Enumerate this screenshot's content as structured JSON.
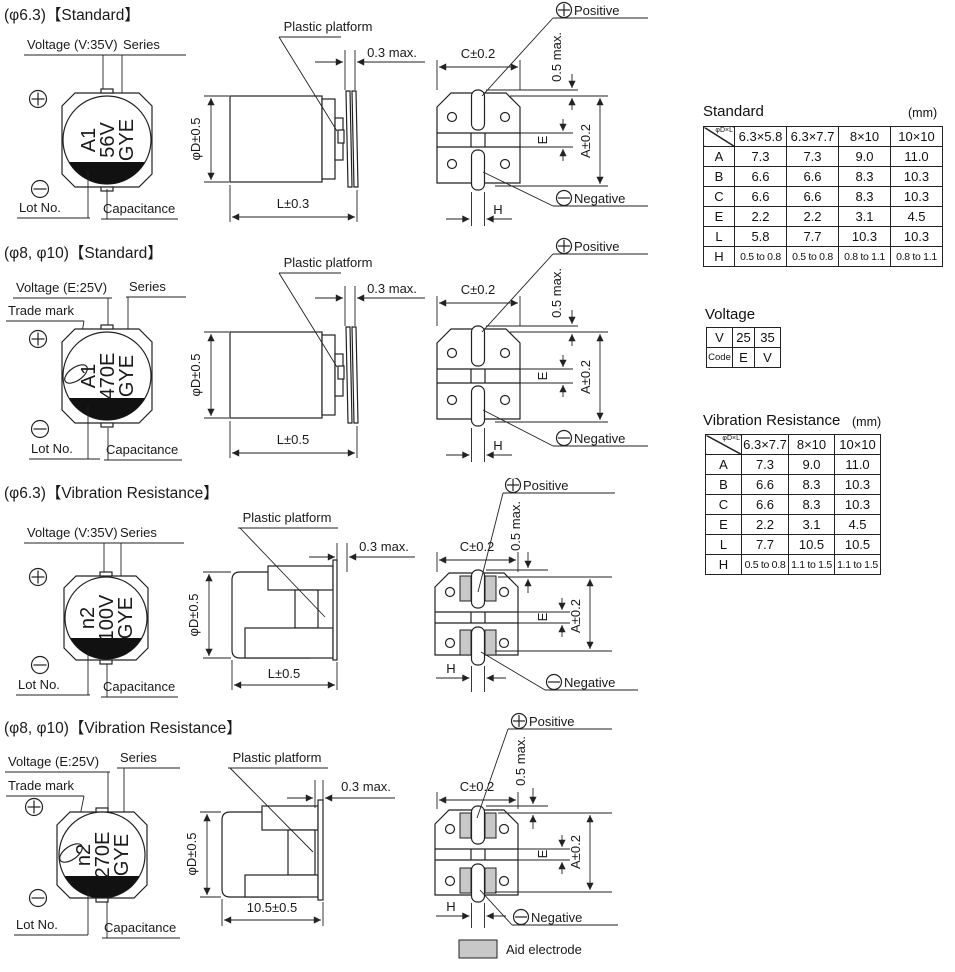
{
  "s1": {
    "title": "(φ6.3)【Standard】",
    "voltage": "Voltage (V:35V)",
    "series": "Series",
    "lot": "Lot No.",
    "cap": "Capacitance",
    "platform": "Plastic platform",
    "gap": "0.3 max.",
    "dia": "φD±0.5",
    "len": "L±0.3",
    "c": "C±0.2",
    "overhang": "0.5 max.",
    "a": "A±0.2",
    "e": "E",
    "h": "H",
    "positive": "Positive",
    "negative": "Negative",
    "m1": "A1",
    "m2": "56V",
    "m3": "GYE"
  },
  "s2": {
    "title": "(φ8, φ10)【Standard】",
    "voltage": "Voltage (E:25V)",
    "series": "Series",
    "trademark": "Trade mark",
    "lot": "Lot No.",
    "cap": "Capacitance",
    "platform": "Plastic platform",
    "gap": "0.3 max.",
    "dia": "φD±0.5",
    "len": "L±0.5",
    "c": "C±0.2",
    "overhang": "0.5 max.",
    "a": "A±0.2",
    "e": "E",
    "h": "H",
    "positive": "Positive",
    "negative": "Negative",
    "m1": "A1",
    "m2": "470E",
    "m3": "GYE"
  },
  "s3": {
    "title": "(φ6.3)【Vibration Resistance】",
    "voltage": "Voltage (V:35V)",
    "series": "Series",
    "lot": "Lot No.",
    "cap": "Capacitance",
    "platform": "Plastic platform",
    "gap": "0.3 max.",
    "dia": "φD±0.5",
    "len": "L±0.5",
    "c": "C±0.2",
    "overhang": "0.5 max.",
    "a": "A±0.2",
    "e": "E",
    "h": "H",
    "positive": "Positive",
    "negative": "Negative",
    "m1": "n2",
    "m2": "100V",
    "m3": "GYE"
  },
  "s4": {
    "title": "(φ8, φ10)【Vibration Resistance】",
    "voltage": "Voltage (E:25V)",
    "series": "Series",
    "trademark": "Trade mark",
    "lot": "Lot No.",
    "cap": "Capacitance",
    "platform": "Plastic platform",
    "gap": "0.3 max.",
    "dia": "φD±0.5",
    "len": "10.5±0.5",
    "c": "C±0.2",
    "overhang": "0.5 max.",
    "a": "A±0.2",
    "e": "E",
    "h": "H",
    "positive": "Positive",
    "negative": "Negative",
    "m1": "n2",
    "m2": "270E",
    "m3": "GYE"
  },
  "legend": {
    "label": "Aid electrode"
  },
  "tables": {
    "standard": {
      "title": "Standard",
      "unit": "(mm)",
      "corner": "φD×L",
      "columns": [
        "6.3×5.8",
        "6.3×7.7",
        "8×10",
        "10×10"
      ],
      "rows": [
        {
          "label": "A",
          "values": [
            "7.3",
            "7.3",
            "9.0",
            "11.0"
          ]
        },
        {
          "label": "B",
          "values": [
            "6.6",
            "6.6",
            "8.3",
            "10.3"
          ]
        },
        {
          "label": "C",
          "values": [
            "6.6",
            "6.6",
            "8.3",
            "10.3"
          ]
        },
        {
          "label": "E",
          "values": [
            "2.2",
            "2.2",
            "3.1",
            "4.5"
          ]
        },
        {
          "label": "L",
          "values": [
            "5.8",
            "7.7",
            "10.3",
            "10.3"
          ]
        },
        {
          "label": "H",
          "values": [
            "0.5 to 0.8",
            "0.5 to 0.8",
            "0.8 to 1.1",
            "0.8 to 1.1"
          ]
        }
      ]
    },
    "voltage": {
      "title": "Voltage",
      "rows": [
        [
          "V",
          "25",
          "35"
        ],
        [
          "Code",
          "E",
          "V"
        ]
      ]
    },
    "vibration": {
      "title": "Vibration Resistance",
      "unit": "(mm)",
      "corner": "φD×L",
      "columns": [
        "6.3×7.7",
        "8×10",
        "10×10"
      ],
      "rows": [
        {
          "label": "A",
          "values": [
            "7.3",
            "9.0",
            "11.0"
          ]
        },
        {
          "label": "B",
          "values": [
            "6.6",
            "8.3",
            "10.3"
          ]
        },
        {
          "label": "C",
          "values": [
            "6.6",
            "8.3",
            "10.3"
          ]
        },
        {
          "label": "E",
          "values": [
            "2.2",
            "3.1",
            "4.5"
          ]
        },
        {
          "label": "L",
          "values": [
            "7.7",
            "10.5",
            "10.5"
          ]
        },
        {
          "label": "H",
          "values": [
            "0.5 to 0.8",
            "1.1 to 1.5",
            "1.1 to 1.5"
          ]
        }
      ]
    }
  }
}
